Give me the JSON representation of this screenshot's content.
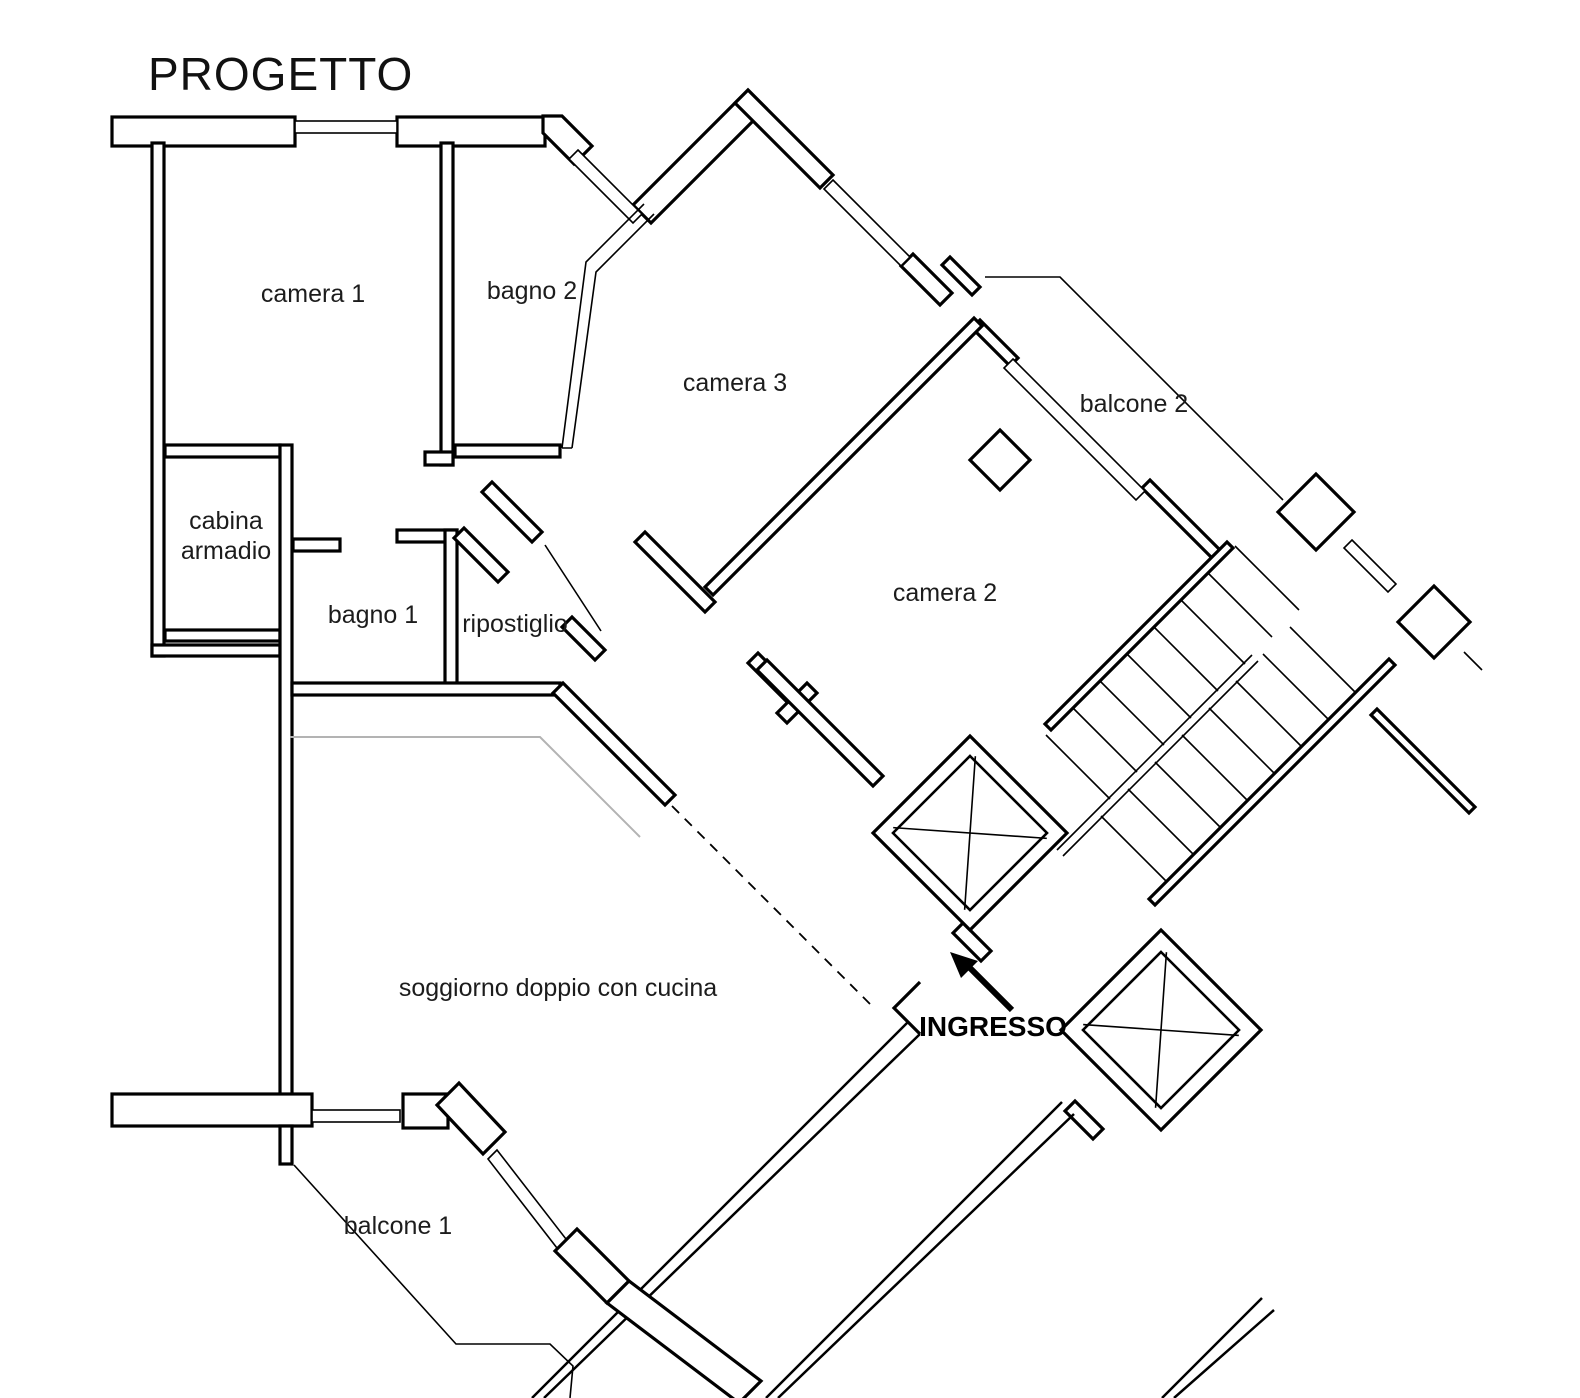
{
  "title": "PROGETTO",
  "colors": {
    "wall": "#000000",
    "background": "#ffffff",
    "gray_line": "#b3b3b3"
  },
  "rooms": {
    "camera1": "camera 1",
    "bagno2": "bagno 2",
    "camera3": "camera 3",
    "balcone2": "balcone 2",
    "cabina_line1": "cabina",
    "cabina_line2": "armadio",
    "bagno1": "bagno 1",
    "ripostiglio": "ripostiglio",
    "camera2": "camera 2",
    "soggiorno": "soggiorno doppio con cucina",
    "balcone1": "balcone 1"
  },
  "entrance": {
    "label": "INGRESSO"
  }
}
